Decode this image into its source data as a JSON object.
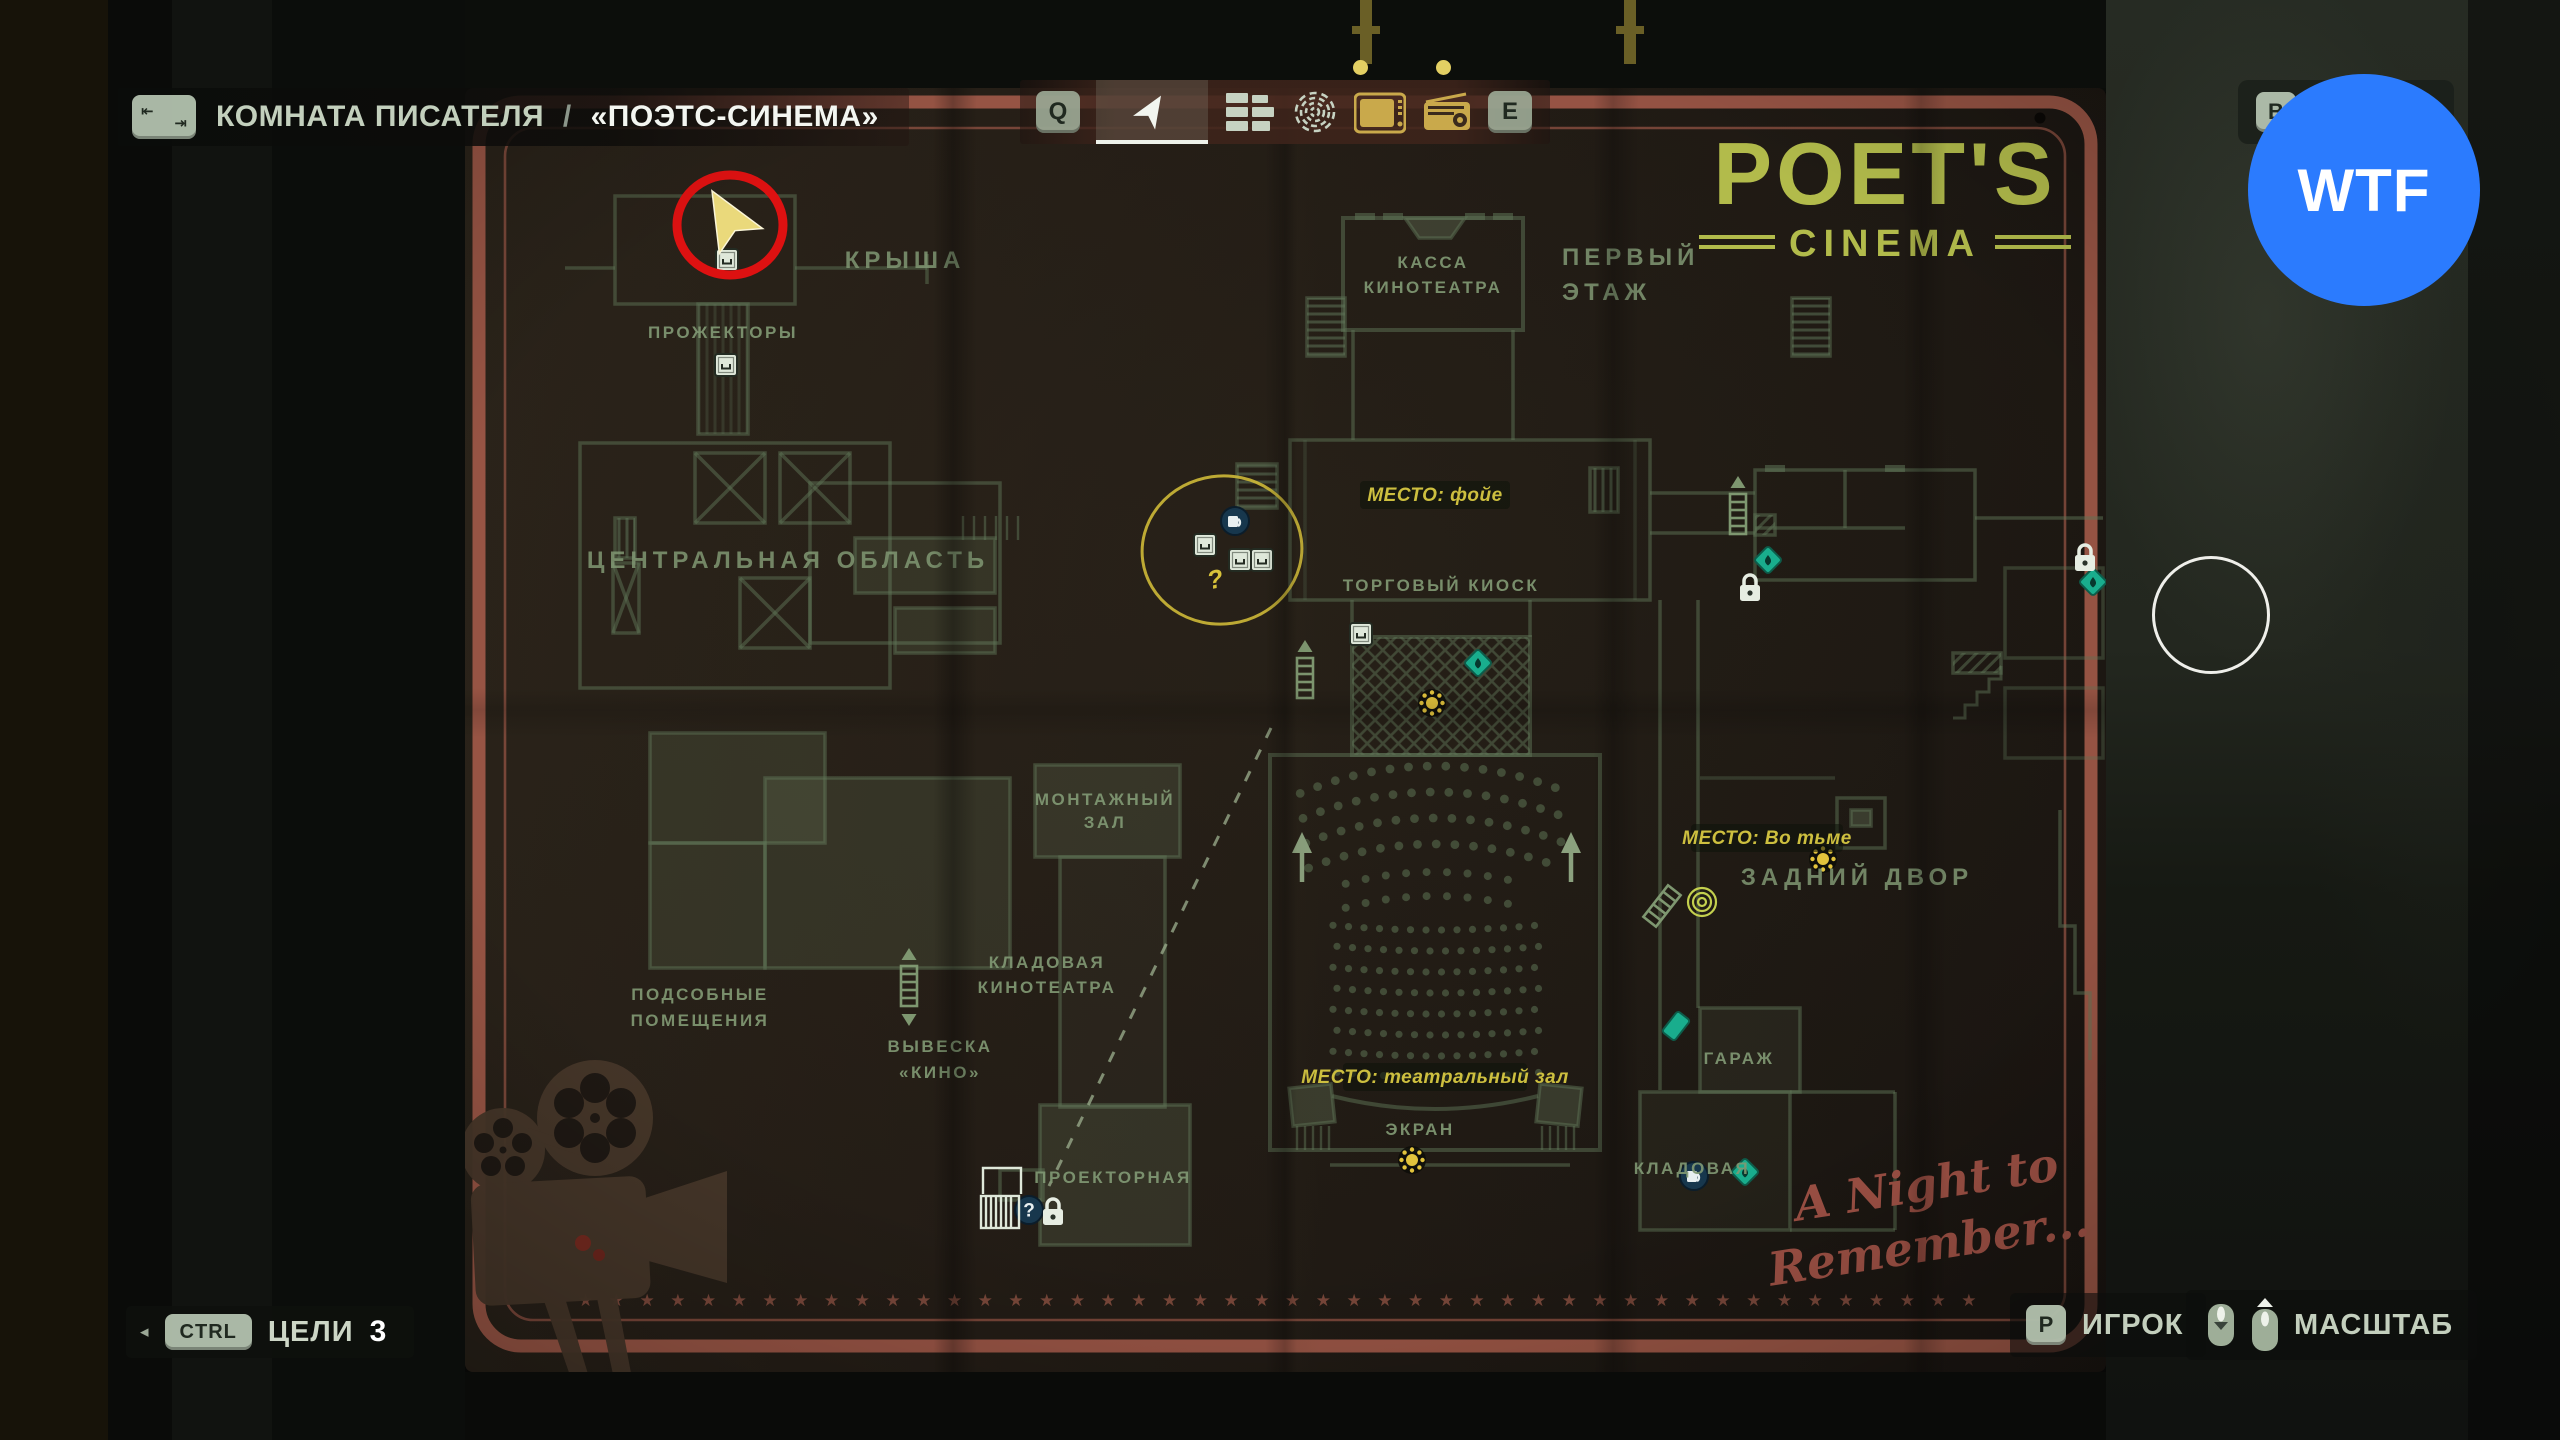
{
  "breadcrumb": {
    "location": "КОМНАТА ПИСАТЕЛЯ",
    "separator": "/",
    "title": "«ПОЭТС-СИНЕМА»"
  },
  "icons": {
    "tab_top": "⇤",
    "tab_bottom": "⇥",
    "question": "?"
  },
  "toolbar": {
    "cycle_left_key": "Q",
    "cycle_right_key": "E"
  },
  "top_right_button": {
    "key": "B",
    "label": "ДЕТАЛИ"
  },
  "watermark": {
    "text": "WTF",
    "color": "#2b7bfe"
  },
  "poster": {
    "brand_title": "POET'S",
    "brand_subtitle": "CINEMA",
    "note_line1": "A Night to",
    "note_line2": "Remember...",
    "labels": {
      "roof": "КРЫША",
      "projectors": "ПРОЖЕКТОРЫ",
      "central_area": "ЦЕНТРАЛЬНАЯ ОБЛАСТЬ",
      "utility_1": "ПОДСОБНЫЕ",
      "utility_2": "ПОМЕЩЕНИЯ",
      "sign_1": "ВЫВЕСКА",
      "sign_2": "«КИНО»",
      "cinema_storage_1": "КЛАДОВАЯ",
      "cinema_storage_2": "КИНОТЕАТРА",
      "editing_1": "МОНТАЖНЫЙ",
      "editing_2": "ЗАЛ",
      "projection": "ПРОЕКТОРНАЯ",
      "box_office_1": "КАССА",
      "box_office_2": "КИНОТЕАТРА",
      "first_floor_1": "ПЕРВЫЙ",
      "first_floor_2": "ЭТАЖ",
      "kiosk": "ТОРГОВЫЙ КИОСК",
      "screen": "ЭКРАН",
      "backyard": "ЗАДНИЙ ДВОР",
      "garage": "ГАРАЖ",
      "storage": "КЛАДОВАЯ",
      "place_foyer": "МЕСТО: фойе",
      "place_dark": "МЕСТО: Во тьме",
      "place_theater": "МЕСТО: театральный зал",
      "annotation_question": "?"
    }
  },
  "objectives": {
    "expand_arrow": "◂",
    "key": "CTRL",
    "label": "ЦЕЛИ",
    "count": "3"
  },
  "controls": {
    "player_key": "P",
    "player_label": "ИГРОК",
    "zoom_label": "МАСШТАБ"
  },
  "colors": {
    "map_line": "#5d7356",
    "label_green": "#809873",
    "accent_yellow": "#cdbf3f",
    "brand_green": "#b2bb4b",
    "border_red": "#a35a49",
    "annotation_red": "#dd1111",
    "annotation_yellow": "#d8c23a",
    "pickup_teal": "#19ad8d",
    "icon_blue": "#17374d",
    "watermark_blue": "#2b7bfe"
  }
}
